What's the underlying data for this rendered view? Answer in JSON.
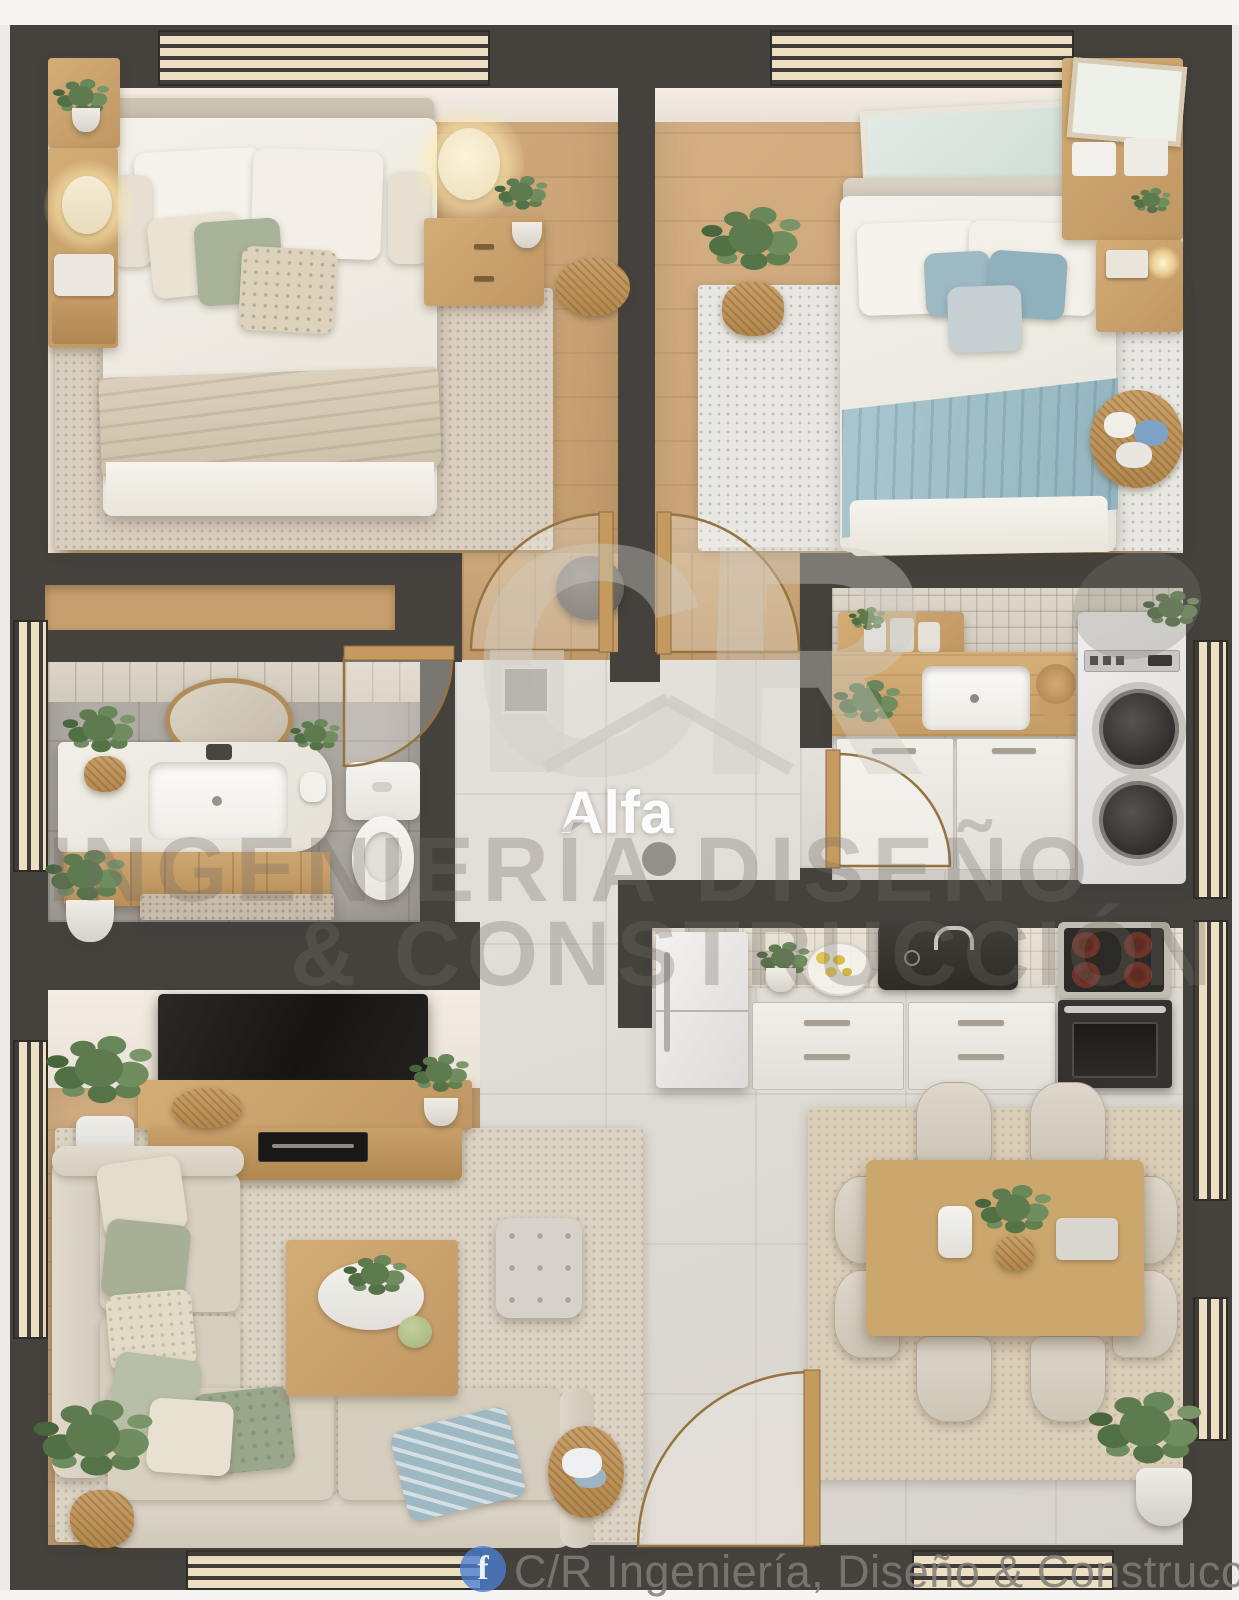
{
  "watermark": {
    "monogram": "CR",
    "brand": "Alfa",
    "line1": "INGENIERÍA DISEÑO",
    "line2": "& CONSTRUCCIÓN"
  },
  "footer": {
    "fb_glyph": "f",
    "text": "C/R Ingeniería, Diseño & Construcción"
  },
  "colors": {
    "wall": "#45423e",
    "wood_floor": "#c9a377",
    "tile_floor": "#dfdcd6",
    "accent_blue": "#a5c2cb",
    "sofa_beige": "#d9d2c4",
    "plant_green": "#5d7b4f",
    "facebook_blue": "#4a7fd4",
    "stove_red": "#7d3b2e",
    "watermark_gray": "#6e6961"
  }
}
